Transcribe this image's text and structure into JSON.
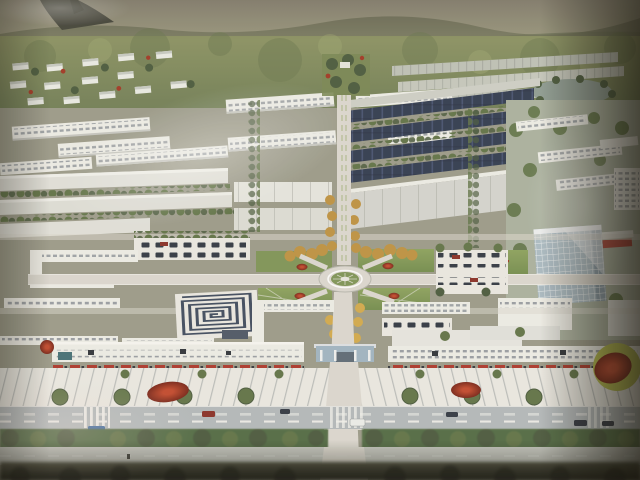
{
  "photo": {
    "kind": "photograph of a printed aerial architectural rendering",
    "subject": "master plan bird's-eye view of an industrial park campus with central landscaped axis, roundabout, factory rows and entrance boulevard"
  },
  "scene_regions": [
    "mountain-backdrop",
    "foothill-villas",
    "distant-warehouse-rows",
    "lake",
    "dormitory-slab-buildings",
    "navy-roof-factory-rows",
    "white-factory-rows",
    "central-axis-boulevard",
    "roundabout-garden",
    "lawn-quadrants",
    "amber-tree-allee",
    "red-shrub-beds",
    "spiral-garden",
    "left-parking-lot",
    "right-parking-lot",
    "office-grid-tower",
    "red-sign-building",
    "entrance-gate",
    "front-office-slabs",
    "red-canopy-trees",
    "striped-forecourt",
    "main-road",
    "hedge-row",
    "outer-road",
    "blurred-foreground"
  ],
  "colors": {
    "sky_top": "#aaa28e",
    "mountain_low": "#8e9070",
    "mountain_ridge": "#73765a",
    "mountain_peak_dark": "#43443a",
    "hill_green": "#818c5c",
    "hill_shadow": "#6b7a4c",
    "tree_green": "#5d7342",
    "tree_dark": "#46593a",
    "hedge_green": "#4e6a40",
    "warehouse_gray": "#bfc3b9",
    "ridge_gray": "#9aa096",
    "building_white": "#f0f0ea",
    "building_shadow": "#c6c8c2",
    "window_gray": "#8a9199",
    "roof_navy": "#2c3850",
    "roof_navy_light": "#47567c",
    "panel_gray": "#b9bbb4",
    "road_light": "#dedbd2",
    "road_main": "#b3bbbe",
    "road_outer": "#c6cac2",
    "lane_white": "#f4f4f0",
    "stripe_gray": "#9ba1a1",
    "plaza_pale": "#edece6",
    "axis_amber": "#c29238",
    "axis_amber_light": "#d8ab42",
    "lawn_green": "#7c9551",
    "lawn_light": "#93a863",
    "shrub_red": "#a8321e",
    "red_band": "#b53326",
    "red_feature_rim": "#b9bf43",
    "spiral_navy": "#3c4a60",
    "lake_gray": "#8d9e94",
    "glass_blue": "#a9bdc8",
    "glass_shade": "#8298a8",
    "tower_grid_white": "#eef3f5",
    "car_dark": "#2e3542",
    "car_red": "#8e2a22",
    "van_white": "#eef0ee",
    "bus_blue": "#3e6ea8",
    "gate_blue": "#9fb6c6",
    "teal_canopy": "#3f6f78",
    "warm_tint": "#e4c49c",
    "bottom_dark": "#22241b"
  }
}
